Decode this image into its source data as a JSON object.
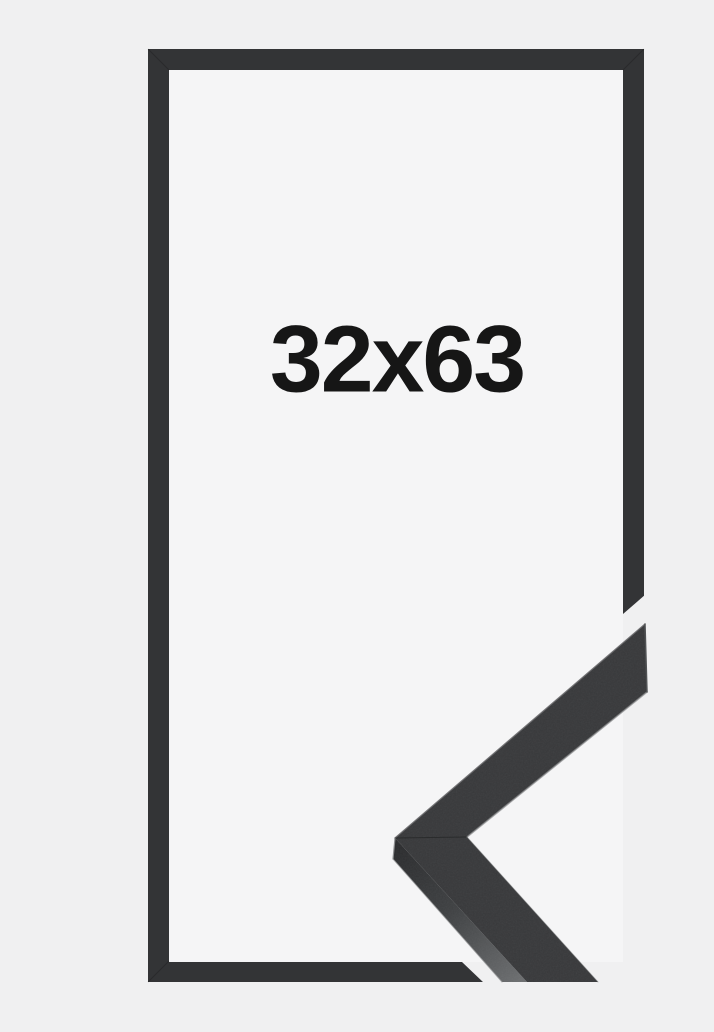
{
  "product": {
    "size_label": "32x63",
    "frame_color_name": "black"
  },
  "colors": {
    "background": "#f0f0f1",
    "inner_background": "#f5f5f6",
    "frame": "#333436",
    "corner_top_face": "#38393b",
    "corner_side_face_light": "#696b6d",
    "label_text": "#161616"
  }
}
